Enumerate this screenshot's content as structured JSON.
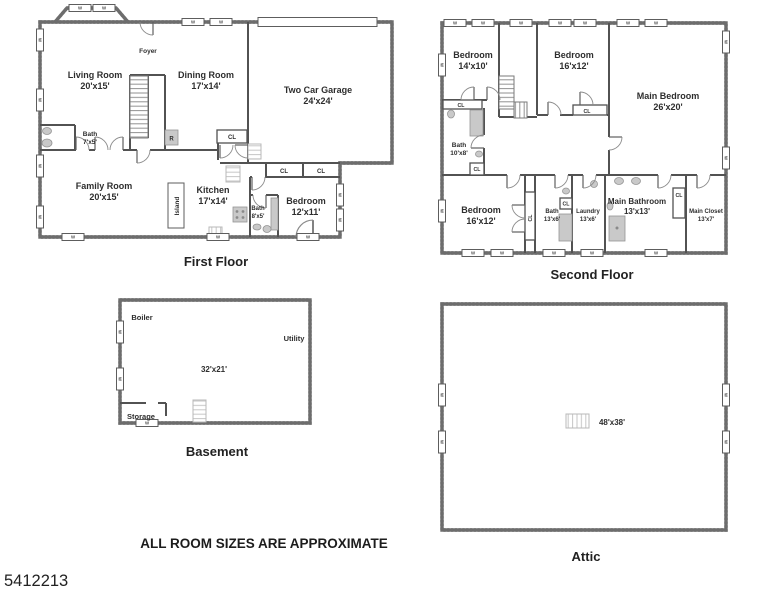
{
  "meta": {
    "listing_id": "5412213",
    "disclaimer": "ALL ROOM SIZES ARE APPROXIMATE"
  },
  "colors": {
    "exterior_wall": "#6d6d6d",
    "interior_wall": "#525252",
    "fixture": "#c9c9c9",
    "text": "#2e2e2e",
    "background": "#ffffff"
  },
  "glyphs": {
    "window": "W",
    "closet": "CL",
    "refrigerator": "R"
  },
  "floors": {
    "first": {
      "title": "First Floor",
      "rooms": {
        "foyer": {
          "name": "Foyer"
        },
        "living": {
          "name": "Living Room",
          "dims": "20'x15'"
        },
        "dining": {
          "name": "Dining Room",
          "dims": "17'x14'"
        },
        "garage": {
          "name": "Two Car Garage",
          "dims": "24'x24'"
        },
        "bath1": {
          "name": "Bath",
          "dims": "7'x5'"
        },
        "family": {
          "name": "Family Room",
          "dims": "20'x15'"
        },
        "kitchen": {
          "name": "Kitchen",
          "dims": "17'x14'"
        },
        "island": {
          "name": "Island"
        },
        "bath2": {
          "name": "Bath",
          "dims": "8'x5'"
        },
        "bedroom": {
          "name": "Bedroom",
          "dims": "12'x11'"
        }
      }
    },
    "second": {
      "title": "Second Floor",
      "rooms": {
        "bedroom1": {
          "name": "Bedroom",
          "dims": "14'x10'"
        },
        "bedroom2": {
          "name": "Bedroom",
          "dims": "16'x12'"
        },
        "main_bedroom": {
          "name": "Main Bedroom",
          "dims": "26'x20'"
        },
        "bath1": {
          "name": "Bath",
          "dims": "10'x8'"
        },
        "bedroom3": {
          "name": "Bedroom",
          "dims": "16'x12'"
        },
        "bath2": {
          "name": "Bath",
          "dims": "13'x6'"
        },
        "laundry": {
          "name": "Laundry",
          "dims": "13'x6'"
        },
        "main_bathroom": {
          "name": "Main Bathroom",
          "dims": "13'x13'"
        },
        "main_closet": {
          "name": "Main Closet",
          "dims": "13'x7'"
        }
      }
    },
    "basement": {
      "title": "Basement",
      "rooms": {
        "boiler": {
          "name": "Boiler"
        },
        "utility": {
          "name": "Utility"
        },
        "main": {
          "dims": "32'x21'"
        },
        "storage": {
          "name": "Storage"
        }
      }
    },
    "attic": {
      "title": "Attic",
      "rooms": {
        "main": {
          "dims": "48'x38'"
        }
      }
    }
  }
}
